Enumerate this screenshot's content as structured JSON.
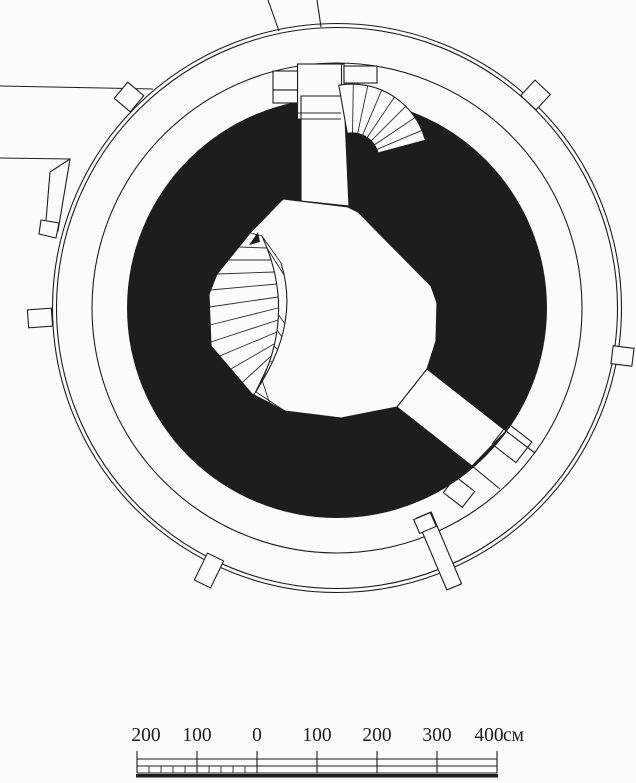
{
  "colors": {
    "ink": "#1d1d1b",
    "paper": "#fcfcfb"
  },
  "scale_bar": {
    "labels": [
      "200",
      "100",
      "0",
      "100",
      "200",
      "300",
      "400"
    ],
    "unit": "см"
  }
}
